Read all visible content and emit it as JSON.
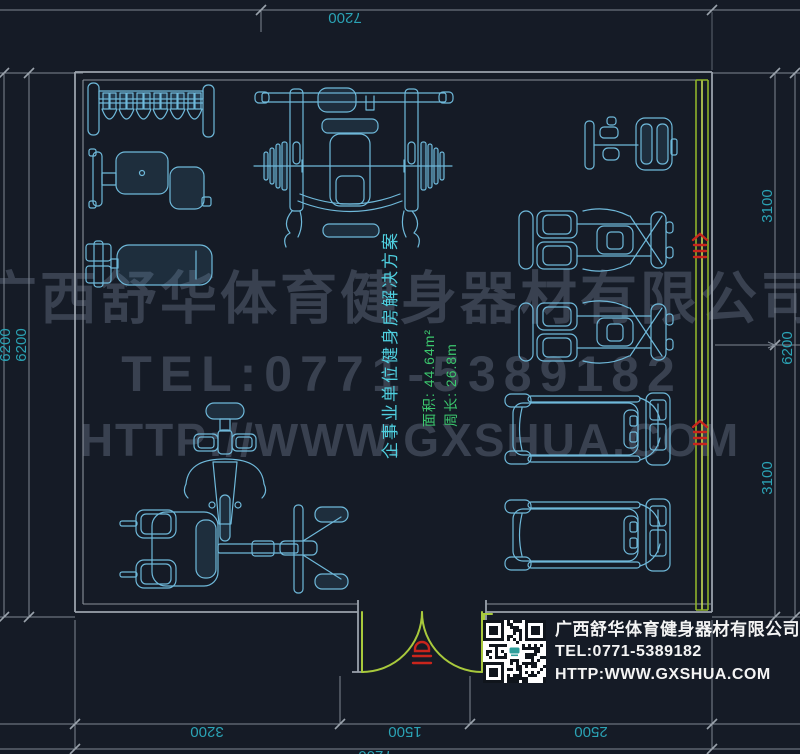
{
  "watermark": {
    "company": "广西舒华体育健身器材有限公司",
    "tel": "TEL:0771-5389182",
    "url": "HTTP://WWW.GXSHUA.COM"
  },
  "plan_label": {
    "title": "企事业单位健身房解决方案",
    "area": "面积: 44.64m²",
    "perimeter": "周长: 26.8m"
  },
  "dimensions": {
    "top": "7200",
    "left": [
      "6200",
      "6200"
    ],
    "right": [
      "3100",
      "6200",
      "3100"
    ],
    "bottom": [
      "3200",
      "1500",
      "2500"
    ],
    "bottom_total": "7200"
  },
  "info_box": {
    "company": "广西舒华体育健身器材有限公司",
    "tel": "TEL:0771-5389182",
    "url": "HTTP:WWW.GXSHUA.COM"
  },
  "equipment": [
    "dumbbell-rack",
    "adjustable-bench",
    "flat-bench",
    "bench-press-station",
    "abductor-machine",
    "recumbent-bike-1",
    "recumbent-bike-2",
    "spin-bike",
    "leg-press-machine",
    "treadmill-1",
    "treadmill-2"
  ],
  "colors": {
    "background": "#151B26",
    "drawing": "#6FB9DA",
    "dim_text": "#2BA3B5",
    "label_title": "#4FD0E0",
    "label_metrics": "#3CC96E",
    "wall": "#9AA2AC",
    "glass_wall": "#A8C93C",
    "annotation_red": "#C9251C",
    "watermark": "#3D4655"
  }
}
